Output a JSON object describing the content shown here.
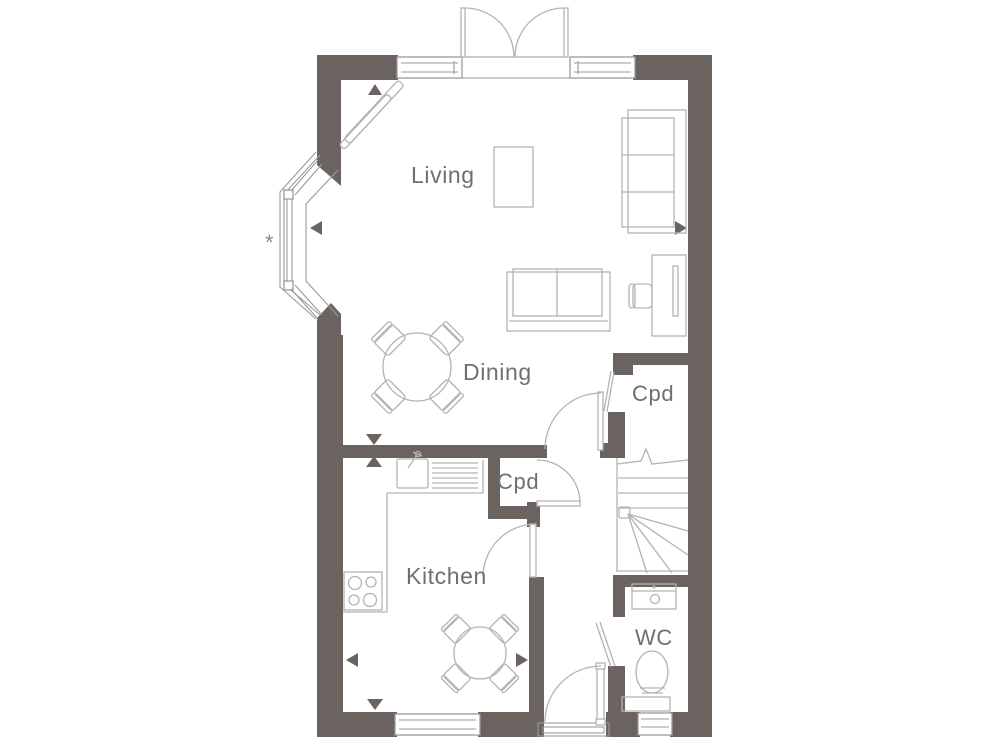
{
  "labels": {
    "living": "Living",
    "dining": "Dining",
    "kitchen": "Kitchen",
    "cupboard_hall": "Cpd",
    "cupboard_upper": "Cpd",
    "wc": "WC"
  },
  "annotations": {
    "bay_window_note_marker": "*"
  },
  "colors": {
    "wall": "#6b6360",
    "line": "#b3b3b3",
    "frame": "#9a9a9a",
    "text": "#6f6f6f",
    "background": "#ffffff"
  }
}
